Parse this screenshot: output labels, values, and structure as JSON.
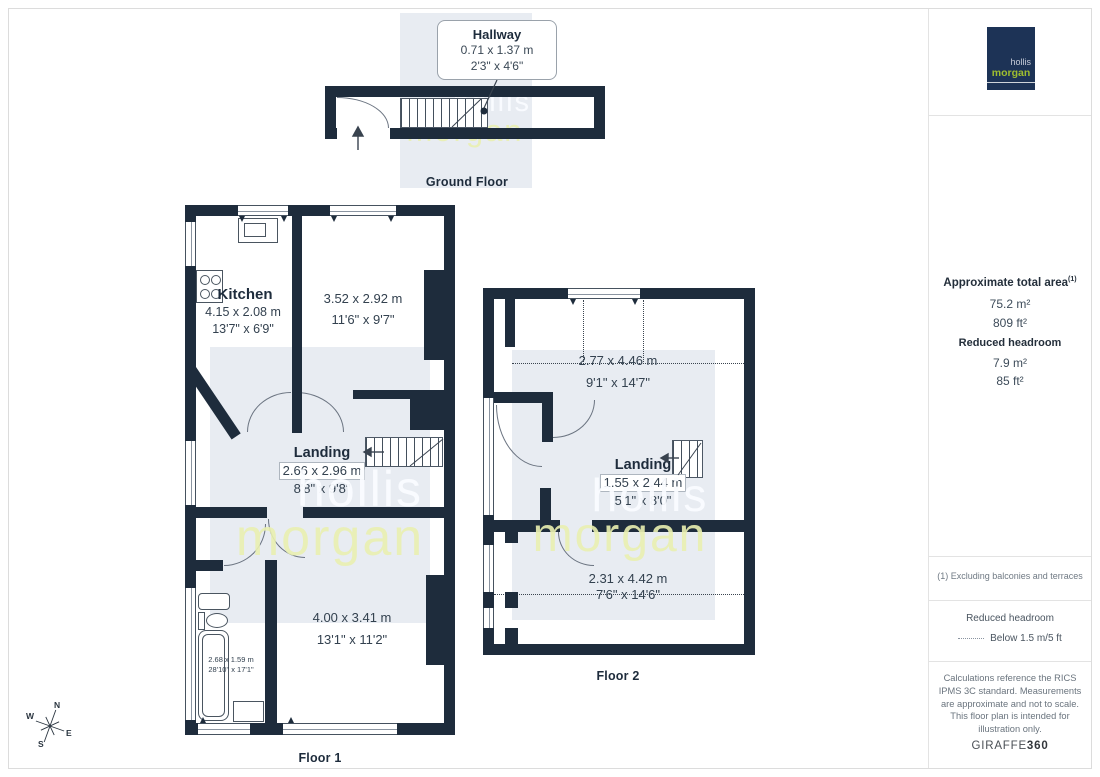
{
  "colors": {
    "wall": "#1e2c3c",
    "shade_band": "#e8ecf2",
    "logo_navy": "#1d3356",
    "logo_green": "#9cbd2e",
    "watermark_yellow": "#ebf2b4"
  },
  "watermark": {
    "line1": "hollis",
    "line2": "morgan"
  },
  "branding": {
    "logo_line1": "hollis",
    "logo_line2": "morgan",
    "giraffe_normal": "GIRAFFE",
    "giraffe_bold": "360"
  },
  "compass": {
    "n": "N",
    "e": "E",
    "s": "S",
    "w": "W"
  },
  "floors": {
    "ground": {
      "label": "Ground Floor",
      "callout": {
        "title": "Hallway",
        "metric": "0.71 x 1.37 m",
        "imperial": "2'3\" x 4'6\""
      }
    },
    "floor1": {
      "label": "Floor 1",
      "kitchen": {
        "name": "Kitchen",
        "metric": "4.15 x 2.08 m",
        "imperial": "13'7\" x 6'9\""
      },
      "front_room": {
        "metric": "3.52 x 2.92 m",
        "imperial": "11'6\" x 9'7\""
      },
      "landing": {
        "name": "Landing",
        "metric": "2.66 x 2.96 m",
        "imperial": "8'8\" x 9'8\""
      },
      "bedroom": {
        "metric": "4.00 x 3.41 m",
        "imperial": "13'1\" x 11'2\""
      },
      "bathroom": {
        "metric": "2.68 x 1.59 m",
        "imperial": "28'10\" x 17'1\""
      }
    },
    "floor2": {
      "label": "Floor 2",
      "top_room": {
        "metric": "2.77 x 4.46 m",
        "imperial": "9'1\" x 14'7\""
      },
      "landing": {
        "name": "Landing",
        "metric": "1.55 x 2.44 m",
        "imperial": "5'1\" x 8'0\""
      },
      "bottom_room": {
        "metric": "2.31 x 4.42 m",
        "imperial": "7'6\" x 14'6\""
      }
    }
  },
  "sidebar": {
    "total_area_title": "Approximate total area",
    "total_area_sup": "(1)",
    "total_area_m2": "75.2 m²",
    "total_area_ft2": "809 ft²",
    "reduced_title": "Reduced headroom",
    "reduced_m2": "7.9 m²",
    "reduced_ft2": "85 ft²",
    "footnote": "(1) Excluding balconies and terraces",
    "legend_title": "Reduced headroom",
    "legend_desc": "Below 1.5 m/5 ft",
    "disclaimer": "Calculations reference the RICS IPMS 3C standard. Measurements are approximate and not to scale. This floor plan is intended for illustration only."
  }
}
